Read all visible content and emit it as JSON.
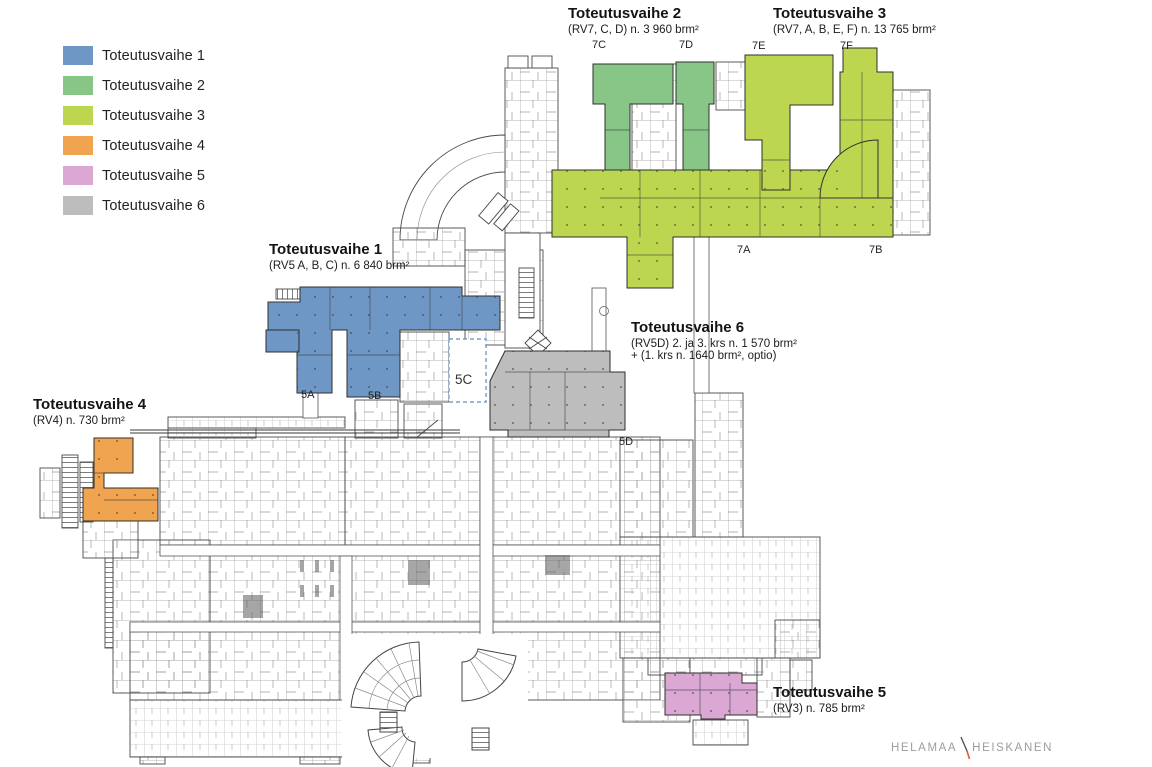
{
  "legend": {
    "items": [
      {
        "label": "Toteutusvaihe 1",
        "color": "#6e97c6"
      },
      {
        "label": "Toteutusvaihe 2",
        "color": "#88c688"
      },
      {
        "label": "Toteutusvaihe 3",
        "color": "#bcd74f"
      },
      {
        "label": "Toteutusvaihe 4",
        "color": "#f0a44f"
      },
      {
        "label": "Toteutusvaihe 5",
        "color": "#dba8d3"
      },
      {
        "label": "Toteutusvaihe 6",
        "color": "#bdbdbd"
      }
    ]
  },
  "annotations": {
    "phase1": {
      "title": "Toteutusvaihe 1",
      "subtitle": "(RV5 A, B, C) n. 6 840 brm²"
    },
    "phase2": {
      "title": "Toteutusvaihe 2",
      "subtitle": "(RV7, C, D) n. 3 960 brm²"
    },
    "phase3": {
      "title": "Toteutusvaihe 3",
      "subtitle": "(RV7, A, B, E, F) n. 13 765 brm²"
    },
    "phase4": {
      "title": "Toteutusvaihe 4",
      "subtitle": "(RV4) n. 730 brm²"
    },
    "phase5": {
      "title": "Toteutusvaihe 5",
      "subtitle": "(RV3) n. 785 brm²"
    },
    "phase6": {
      "title": "Toteutusvaihe 6",
      "subtitle": "(RV5D) 2. ja 3. krs n. 1 570 brm²",
      "subtitle2": "+ (1. krs n. 1640 brm², optio)"
    }
  },
  "wing_labels": {
    "w7c": "7C",
    "w7d": "7D",
    "w7e": "7E",
    "w7f": "7F",
    "w7a": "7A",
    "w7b": "7B",
    "w5a": "5A",
    "w5b": "5B",
    "w5c": "5C",
    "w5d": "5D"
  },
  "logo": {
    "part1": "HELAMAA",
    "part2": "HEISKANEN"
  },
  "colors": {
    "phase1": "#6e97c6",
    "phase2": "#88c688",
    "phase3": "#bcd74f",
    "phase4": "#f0a44f",
    "phase5": "#dba8d3",
    "phase6": "#bdbdbd",
    "accent5c": "#5b8ec4",
    "logo_accent": "#e05a33"
  }
}
